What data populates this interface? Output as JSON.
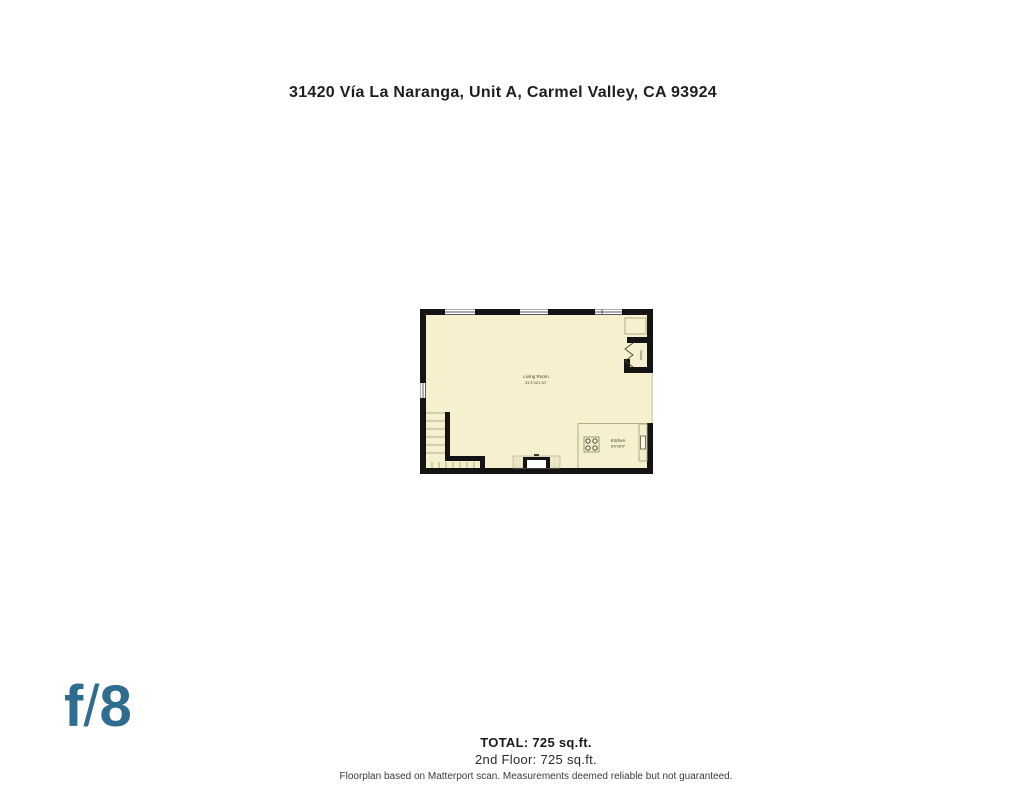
{
  "page": {
    "title": "31420 Vía La Naranga, Unit A, Carmel Valley, CA 93924"
  },
  "floorplan": {
    "fill_color": "#f6f0ce",
    "wall_color": "#141414",
    "detail_line_color": "#b3ac83",
    "rooms": [
      {
        "name": "Living Room",
        "dimensions": "31'3\"x21'10\""
      },
      {
        "name": "Kitchen",
        "dimensions": "8'8\"x8'9\""
      },
      {
        "name": "Closet",
        "dimensions": ""
      }
    ],
    "icons": [
      "window-icon",
      "stairs-icon",
      "fireplace-icon",
      "stove-icon",
      "sink-icon",
      "bifold-door-icon",
      "closet-shelf-icon"
    ]
  },
  "logo": {
    "f": "f",
    "slash": "/",
    "eight": "8",
    "color": "#2e6c90"
  },
  "footer": {
    "total": "TOTAL: 725 sq.ft.",
    "floor_line": "2nd Floor: 725 sq.ft.",
    "disclaimer": "Floorplan based on Matterport scan. Measurements deemed reliable but not guaranteed."
  }
}
